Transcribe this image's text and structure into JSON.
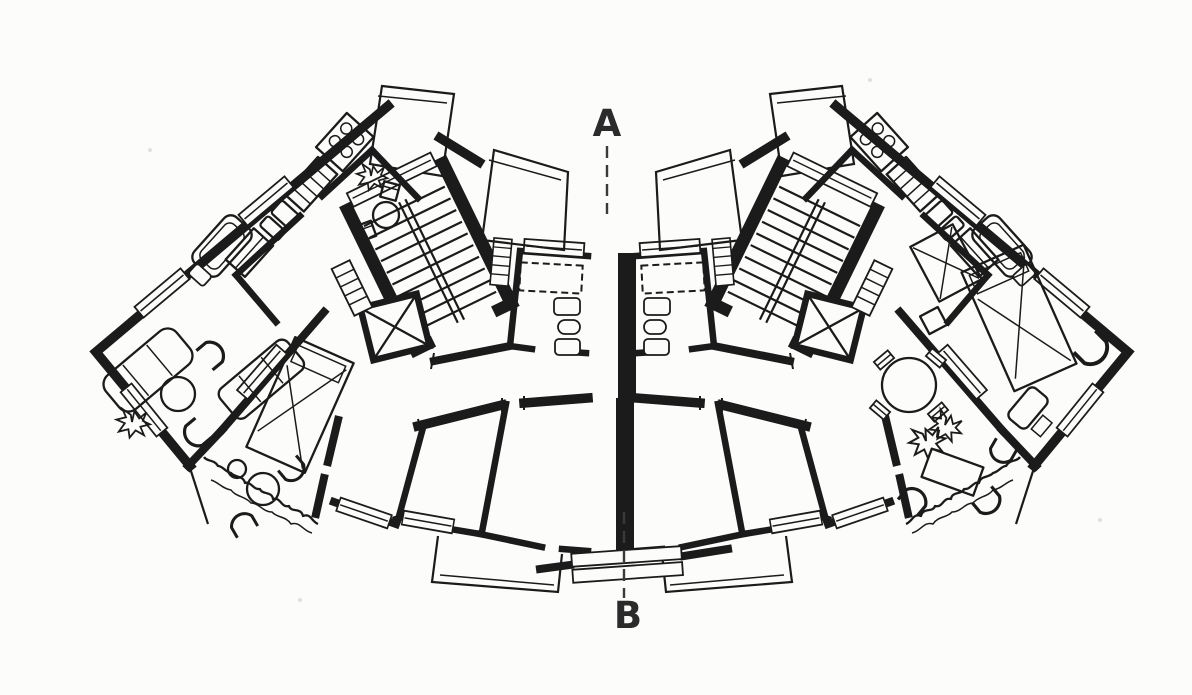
{
  "drawing": {
    "type": "architectural floor plan",
    "subject": "curved fan-shaped apartment block, typical floor, black ink on white paper"
  },
  "section_labels": {
    "top": "A",
    "bottom": "B"
  },
  "colors": {
    "ink": "#1b1b1b",
    "paper": "#fcfcfa",
    "label": "#2b2b2b"
  },
  "symbols": [
    "stairwell",
    "elevator-shaft",
    "bathtub",
    "wc-fixtures",
    "kitchen-stove-4-burners",
    "sink",
    "double-bed",
    "sofa",
    "round-table",
    "chair",
    "balcony-railing",
    "planting-shrubs",
    "window-bar",
    "duct-shaft",
    "section-axis"
  ]
}
